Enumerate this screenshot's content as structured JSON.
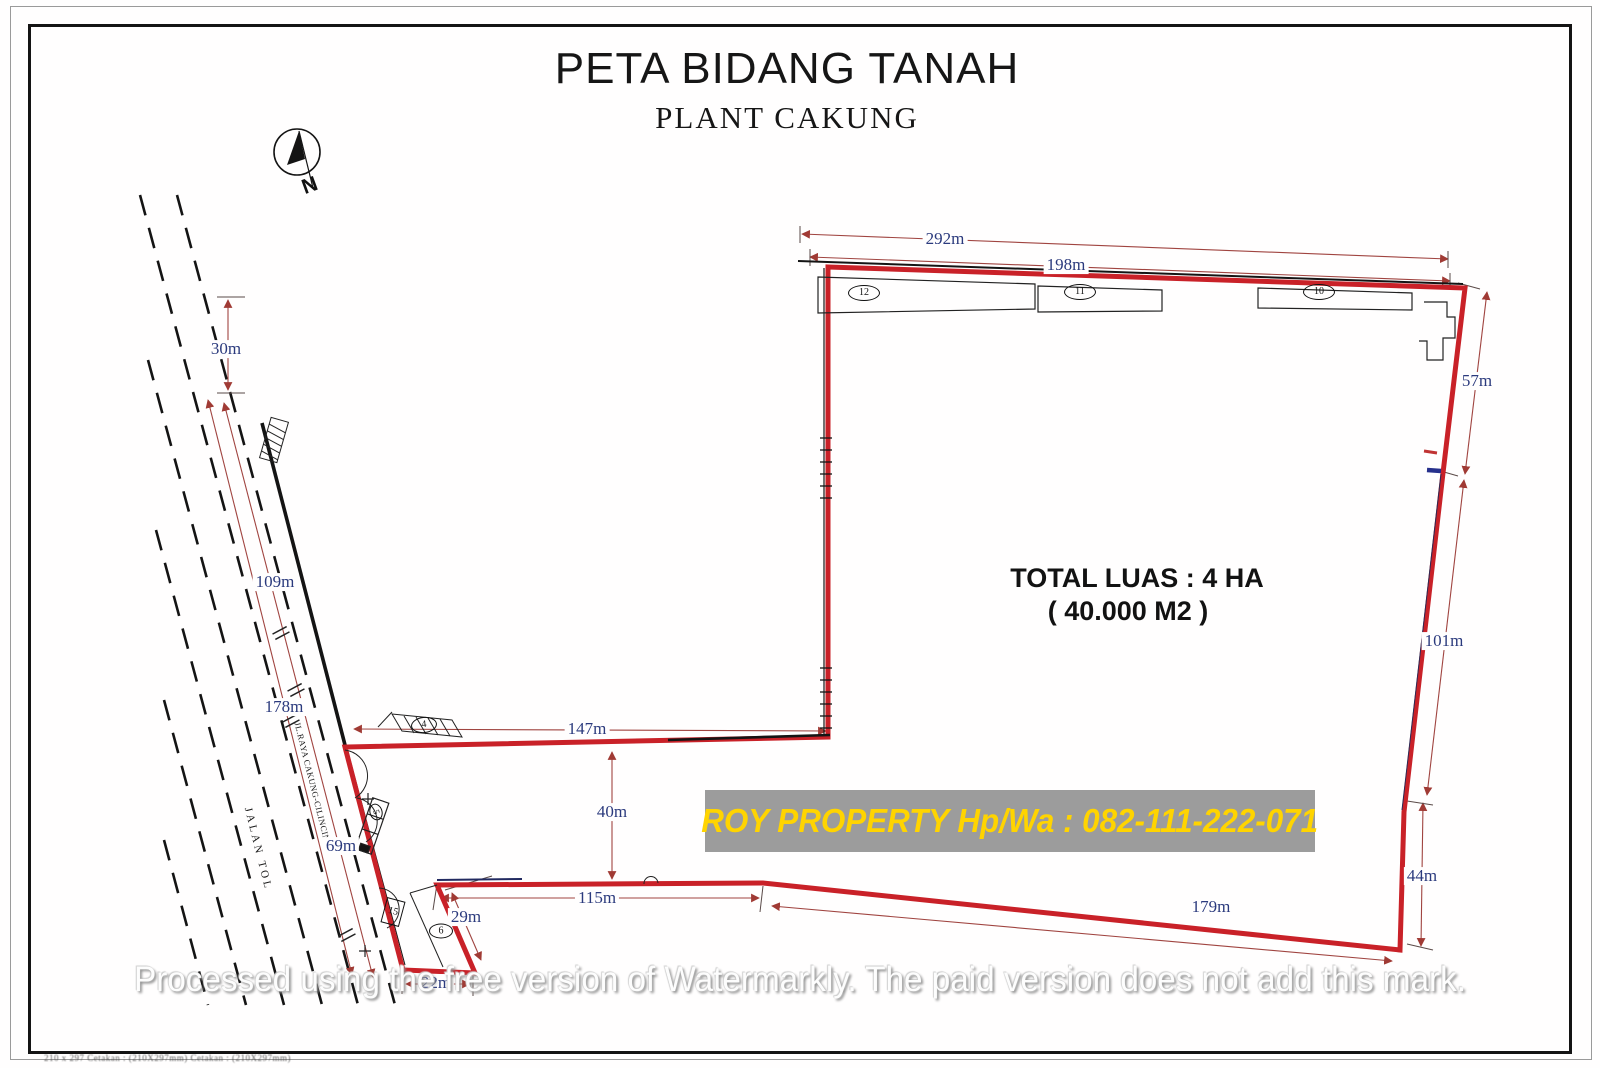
{
  "title": {
    "main": "PETA BIDANG TANAH",
    "sub": "PLANT CAKUNG"
  },
  "compass": {
    "label": "N"
  },
  "area": {
    "line1": "TOTAL LUAS : 4 HA",
    "line2": "( 40.000 M2 )"
  },
  "banner": {
    "text": "ROY PROPERTY Hp/Wa : 082-111-222-071",
    "bg": "#9c9c9c",
    "fg": "#ffd400"
  },
  "watermark": {
    "text": "Processed using the free version of Watermarkly. The paid version does not add this mark."
  },
  "roads": {
    "main": "JL.RAYA CAKUNG-CILINCING",
    "toll": "JALAN TOL"
  },
  "dimensions": {
    "top_outer": "292m",
    "top_inner": "198m",
    "north_gap": "30m",
    "west_upper": "109m",
    "west_full": "178m",
    "west_lower": "69m",
    "east_upper": "57m",
    "east_middle": "101m",
    "east_lower": "44m",
    "inner_depth": "40m",
    "inner_width": "147m",
    "bottom_inner": "115m",
    "bottom_outer": "179m",
    "notch_side": "29m",
    "notch_base": "22m"
  },
  "parcels": {
    "p12": "12",
    "p11": "11",
    "p10": "10",
    "p4": "4",
    "p6": "6",
    "p5": "5",
    "p15": "15"
  },
  "fineprint": "210 x 297   Cetakan : (210X297mm)   Cetakan : (210X297mm)",
  "colors": {
    "boundary_red": "#c92128",
    "dim_text_navy": "#2b3a7d",
    "dim_line": "#a04440",
    "ink": "#141414"
  }
}
